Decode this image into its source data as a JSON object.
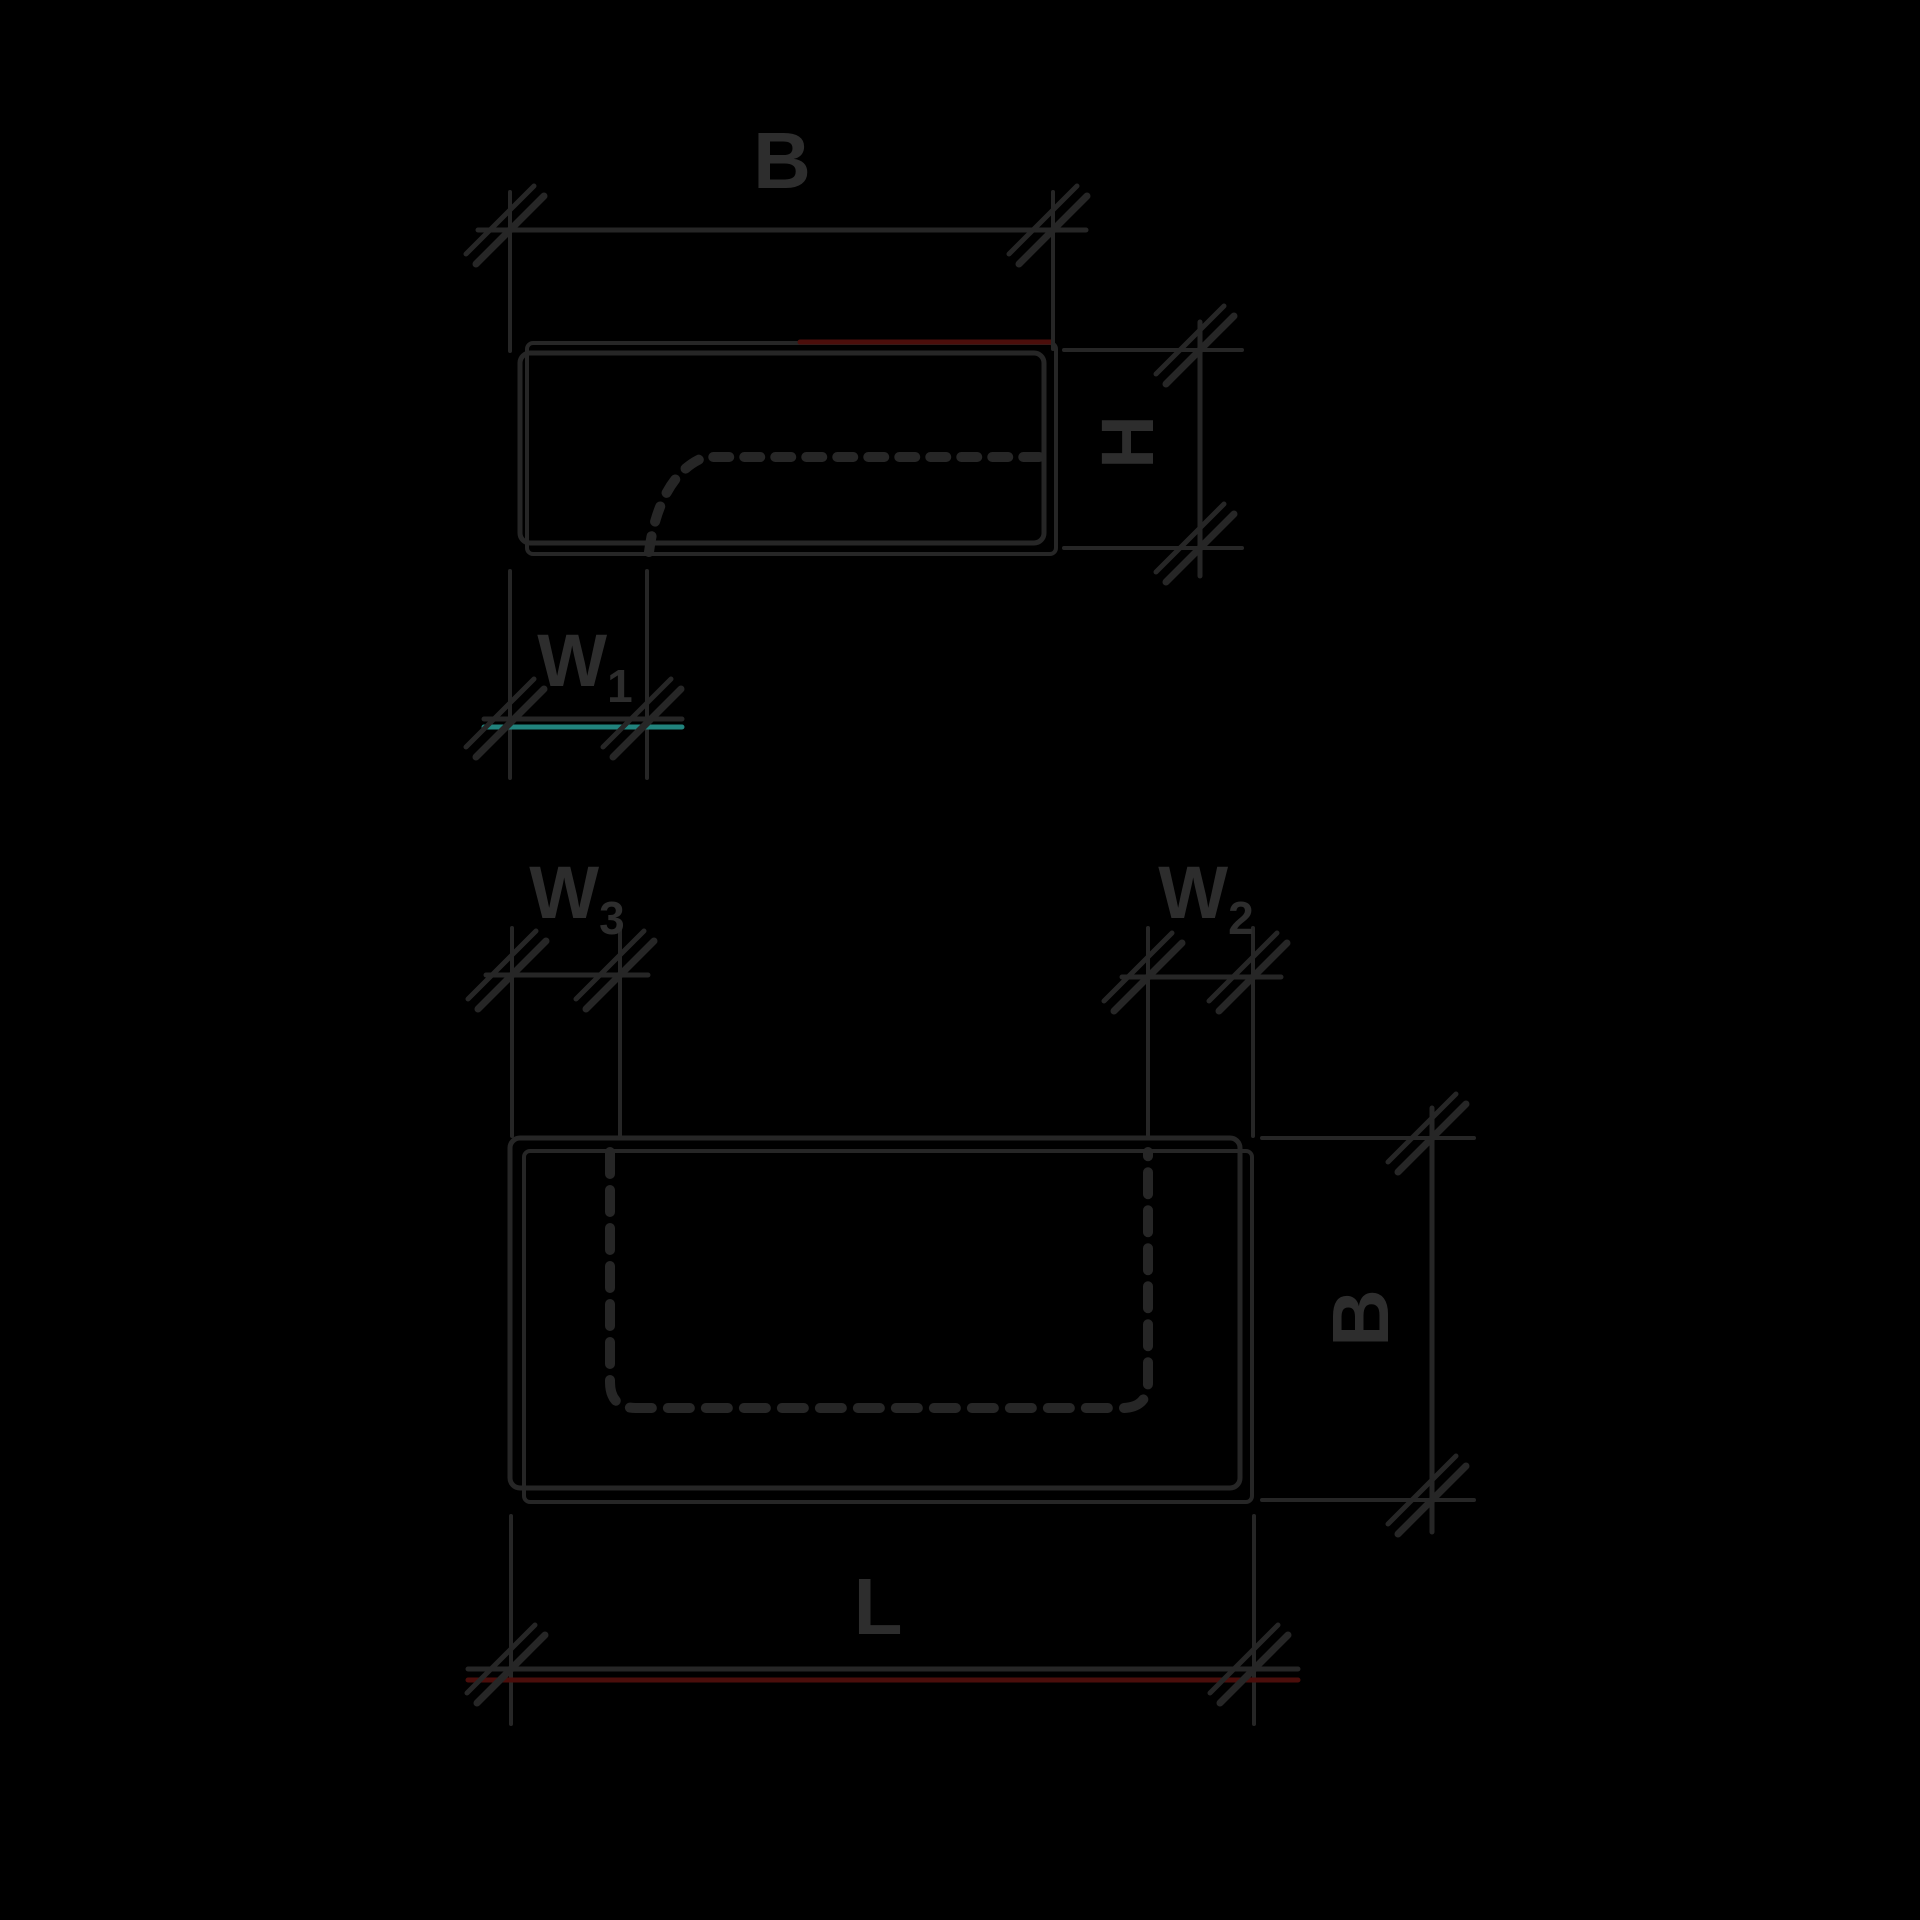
{
  "diagram": {
    "description": "Black-background technical dimension drawing of a hollow block shown in two views: end cross-section (top) and side view (bottom), drawn in a sketchy double-stroke style with architectural tick arrows and dashed cavity outlines.",
    "colors": {
      "background": "#000000",
      "line": "#262626",
      "text": "#2d2d2d",
      "accent_red": "#4b0e0b",
      "accent_teal": "#21837d"
    },
    "views": {
      "end_view": {
        "name": "end cross-section view",
        "dim_width": {
          "label": "B"
        },
        "dim_height": {
          "label": "H"
        },
        "dim_wall": {
          "label": "W",
          "sub": "1"
        }
      },
      "side_view": {
        "name": "side view",
        "dim_wall_left": {
          "label": "W",
          "sub": "3"
        },
        "dim_wall_right": {
          "label": "W",
          "sub": "2"
        },
        "dim_width": {
          "label": "B"
        },
        "dim_length": {
          "label": "L"
        }
      }
    }
  }
}
